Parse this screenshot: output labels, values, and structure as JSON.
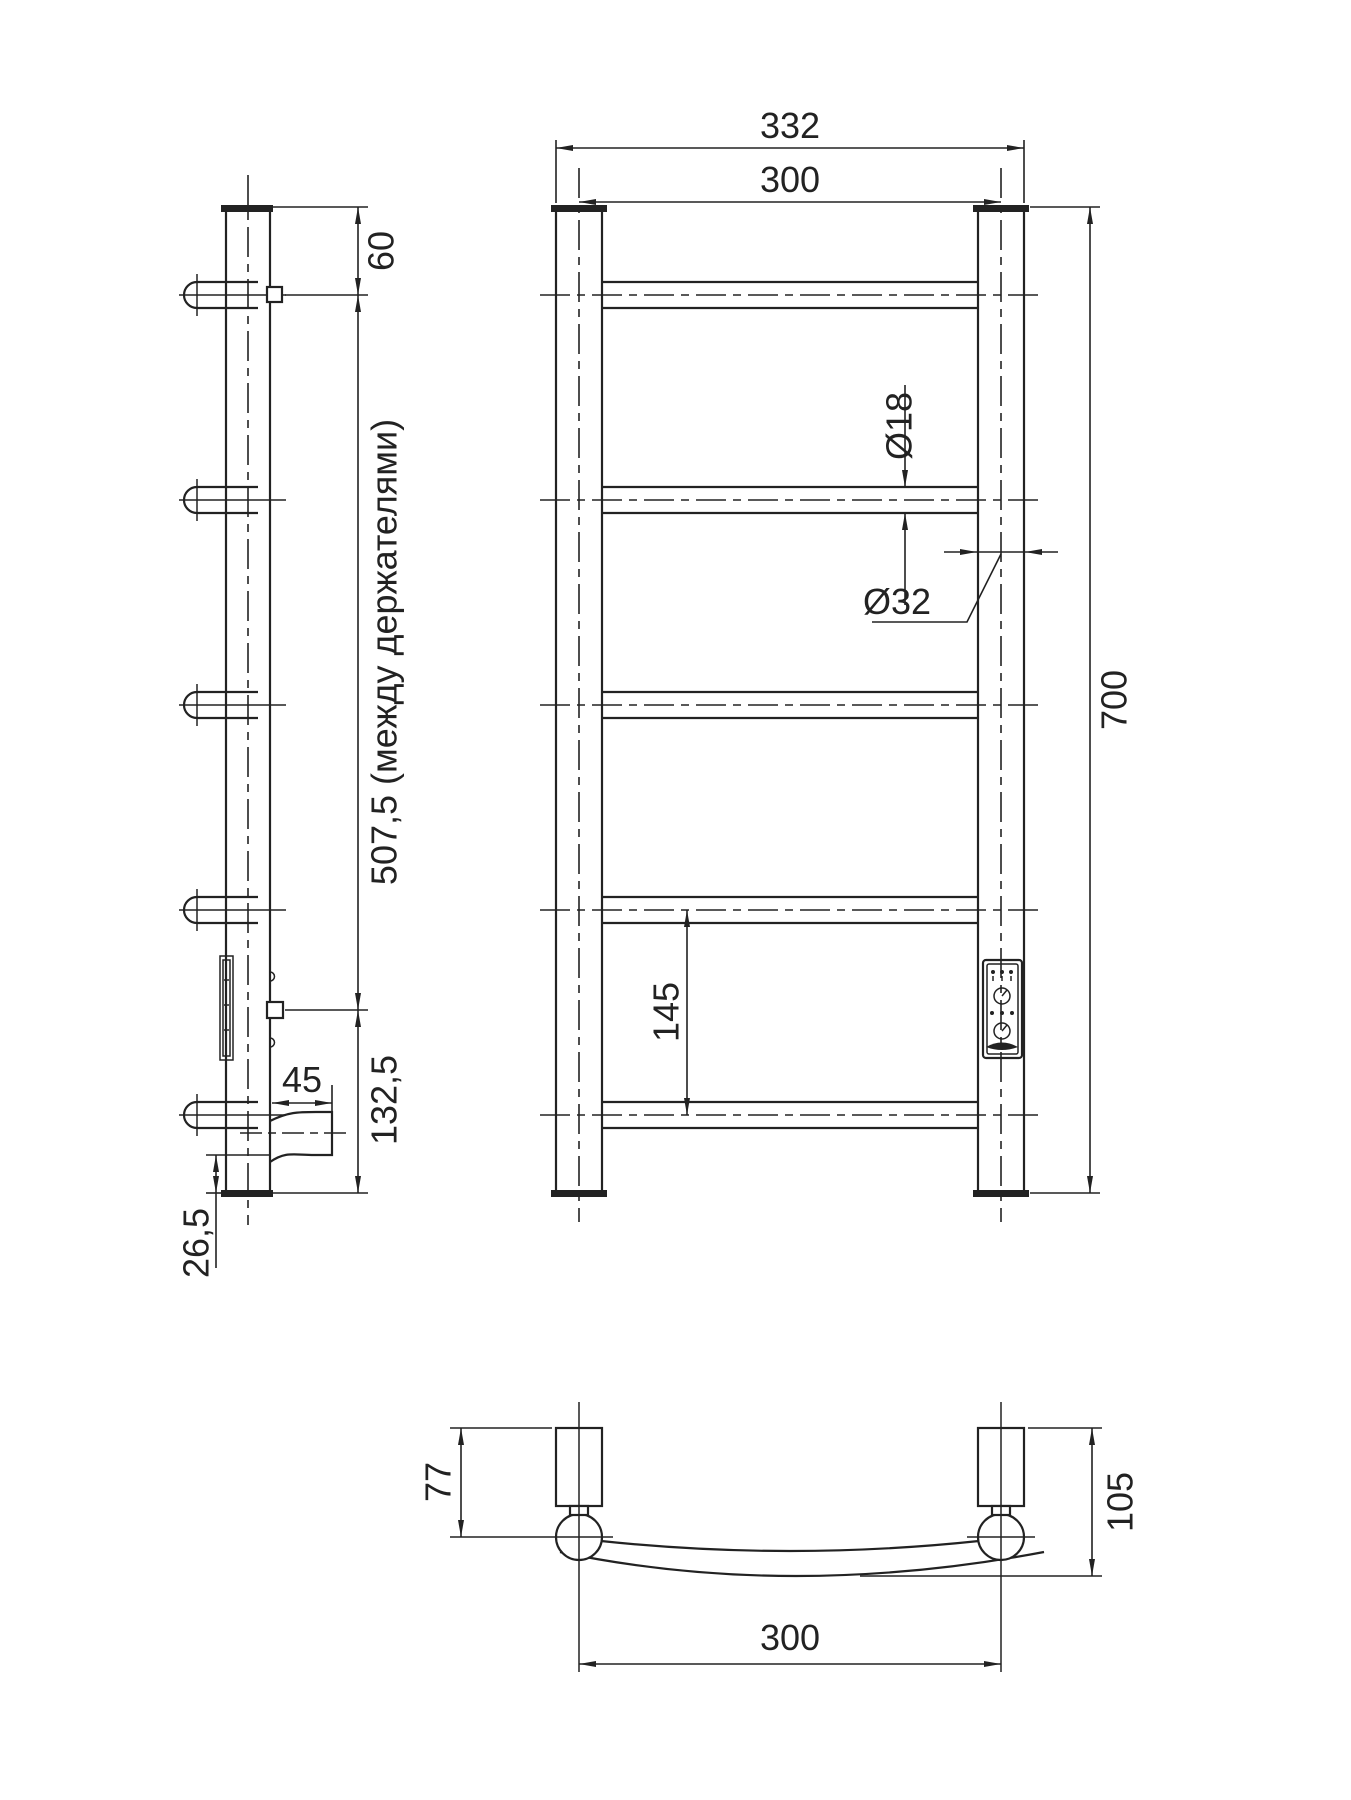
{
  "colors": {
    "ink": "#222222",
    "background": "#ffffff"
  },
  "views": {
    "side": {
      "dims": {
        "top_offset": "60",
        "between_holders": "507,5 (между держателями)",
        "holder_to_bottom": "132,5",
        "cable_length": "45",
        "cable_to_end": "26,5"
      }
    },
    "front": {
      "dims": {
        "overall_width": "332",
        "rail_width": "300",
        "rung_diameter": "Ø18",
        "post_diameter": "Ø32",
        "overall_height": "700",
        "rung_spacing": "145"
      }
    },
    "bottom": {
      "dims": {
        "bracket_depth": "77",
        "overall_depth": "105",
        "rail_width": "300"
      }
    }
  }
}
